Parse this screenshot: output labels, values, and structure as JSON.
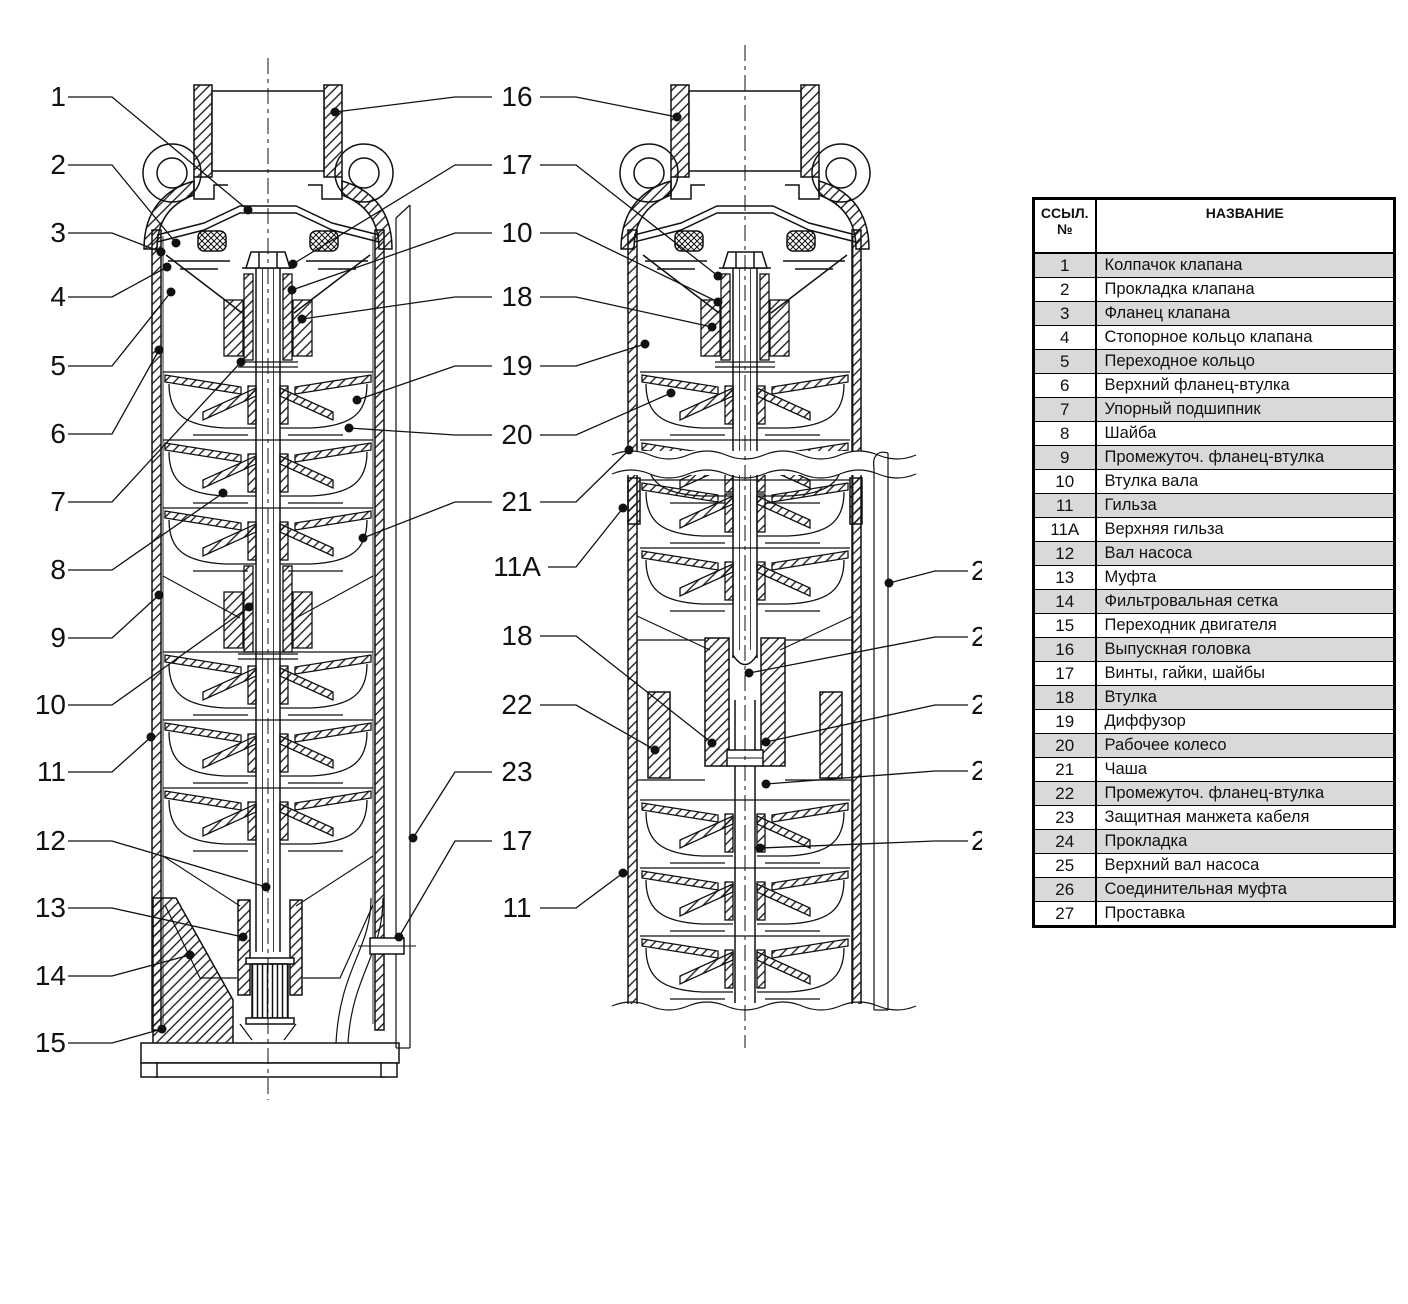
{
  "figure": {
    "kind": "technical cross-section diagram",
    "subject": "submersible multistage borehole pump, two sectional views with numbered part callouts"
  },
  "callouts": {
    "left": [
      "1",
      "2",
      "3",
      "4",
      "5",
      "6",
      "7",
      "8",
      "9",
      "10",
      "11",
      "12",
      "13",
      "14",
      "15"
    ],
    "middle": [
      "16",
      "17",
      "10",
      "18",
      "19",
      "20",
      "21",
      "11A",
      "18",
      "22",
      "23",
      "17",
      "11"
    ],
    "right_truncated": [
      "2",
      "2",
      "2",
      "2",
      "2"
    ]
  },
  "table": {
    "header": {
      "ref_line1": "ССЫЛ.",
      "ref_line2": "№",
      "name": "НАЗВАНИЕ"
    },
    "rows": [
      {
        "ref": "1",
        "name": "Колпачок клапана"
      },
      {
        "ref": "2",
        "name": "Прокладка клапана"
      },
      {
        "ref": "3",
        "name": "Фланец клапана"
      },
      {
        "ref": "4",
        "name": "Стопорное кольцо клапана"
      },
      {
        "ref": "5",
        "name": "Переходное кольцо"
      },
      {
        "ref": "6",
        "name": "Верхний фланец-втулка"
      },
      {
        "ref": "7",
        "name": "Упорный подшипник"
      },
      {
        "ref": "8",
        "name": "Шайба"
      },
      {
        "ref": "9",
        "name": "Промежуточ. фланец-втулка"
      },
      {
        "ref": "10",
        "name": "Втулка вала"
      },
      {
        "ref": "11",
        "name": "Гильза"
      },
      {
        "ref": "11A",
        "name": "Верхняя гильза"
      },
      {
        "ref": "12",
        "name": "Вал насоса"
      },
      {
        "ref": "13",
        "name": "Муфта"
      },
      {
        "ref": "14",
        "name": "Фильтровальная сетка"
      },
      {
        "ref": "15",
        "name": "Переходник двигателя"
      },
      {
        "ref": "16",
        "name": "Выпускная головка"
      },
      {
        "ref": "17",
        "name": "Винты, гайки, шайбы"
      },
      {
        "ref": "18",
        "name": "Втулка"
      },
      {
        "ref": "19",
        "name": "Диффузор"
      },
      {
        "ref": "20",
        "name": "Рабочее колесо"
      },
      {
        "ref": "21",
        "name": "Чаша"
      },
      {
        "ref": "22",
        "name": "Промежуточ. фланец-втулка"
      },
      {
        "ref": "23",
        "name": "Защитная манжета кабеля"
      },
      {
        "ref": "24",
        "name": "Прокладка"
      },
      {
        "ref": "25",
        "name": "Верхний вал насоса"
      },
      {
        "ref": "26",
        "name": "Соединительная муфта"
      },
      {
        "ref": "27",
        "name": "Проставка"
      }
    ]
  },
  "colors": {
    "line": "#111111",
    "row_shade": "#d9d9d9",
    "background": "#ffffff"
  }
}
